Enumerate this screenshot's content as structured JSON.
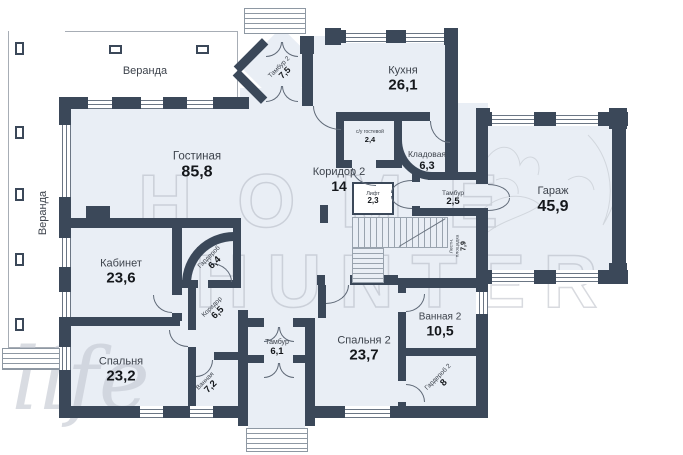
{
  "colors": {
    "wall": "#3b4859",
    "room_fill": "#e9eef5",
    "detail_line": "#99a3ae",
    "room_name_text": "#3d434c",
    "area_number_text": "#14171b",
    "watermark": "#a2a8b2"
  },
  "watermark": {
    "line1": "HOME",
    "line2": "HUNTER",
    "script": "life"
  },
  "labels": {
    "veranda_top": "Веранда",
    "veranda_left": "Веранда"
  },
  "rooms": {
    "living": {
      "name": "Гостиная",
      "area": "85,8"
    },
    "kitchen": {
      "name": "Кухня",
      "area": "26,1"
    },
    "corridor2": {
      "name": "Коридор 2",
      "area": "14"
    },
    "tambour2": {
      "name": "Тамбур 2",
      "area": "7,5"
    },
    "guest_wc": {
      "name": "с/у гостевой",
      "area": "2,4"
    },
    "pantry": {
      "name": "Кладовая",
      "area": "6,3"
    },
    "tambour_garage": {
      "name": "Тамбур",
      "area": "2,5"
    },
    "lift": {
      "name": "Лифт",
      "area": "2,3"
    },
    "stair_landing": {
      "name": "Лестн. площадка",
      "area": "7,9"
    },
    "garage": {
      "name": "Гараж",
      "area": "45,9"
    },
    "office": {
      "name": "Кабинет",
      "area": "23,6"
    },
    "wardrobe": {
      "name": "Гардероб",
      "area": "6,4"
    },
    "corridor": {
      "name": "Коридор",
      "area": "6,5"
    },
    "bedroom": {
      "name": "Спальня",
      "area": "23,2"
    },
    "bathroom": {
      "name": "Ванная",
      "area": "7,2"
    },
    "tambour_south": {
      "name": "Тамбур",
      "area": "6,1"
    },
    "bedroom2": {
      "name": "Спальня 2",
      "area": "23,7"
    },
    "bathroom2": {
      "name": "Ванная 2",
      "area": "10,5"
    },
    "wardrobe2": {
      "name": "Гардероб 2",
      "area": "8"
    }
  }
}
